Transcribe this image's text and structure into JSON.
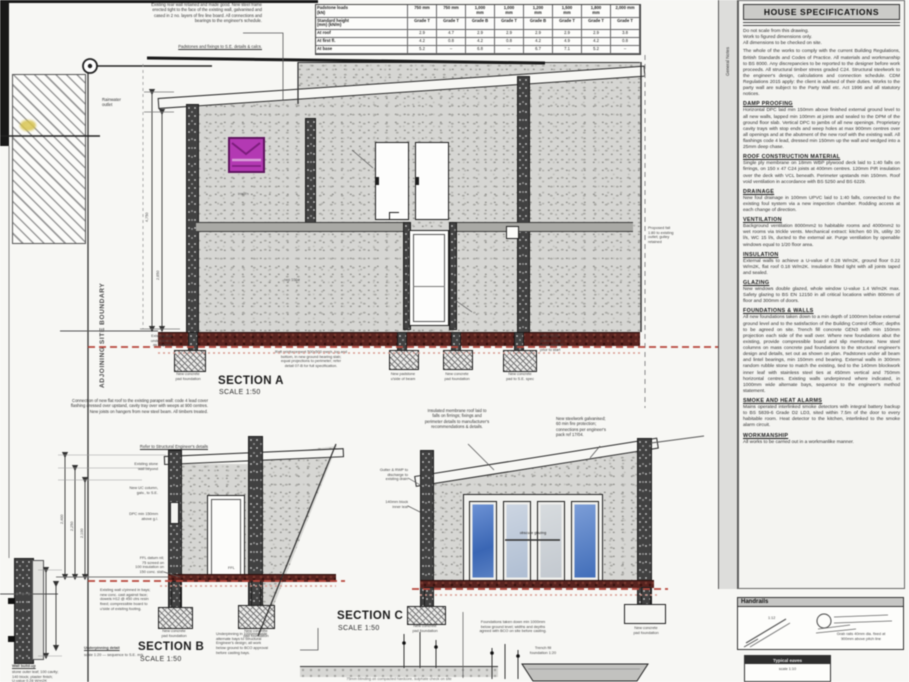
{
  "colors": {
    "accent_magenta": "#b339b3",
    "slab_maroon": "#58231f",
    "dash_red": "#b8473c",
    "glazing_blue": "#3f6cb8"
  },
  "boundary": {
    "left_vertical": "ADJOINING SITE BOUNDARY",
    "right_vertical": "SITE BOUNDARY",
    "sidebar_vertical": "General Notes"
  },
  "top_left": {
    "corner_note": "Rainwater\noutlet"
  },
  "top_note": {
    "body": "Existing rear wall retained and made good. New steel frame erected tight to the face of the existing wall, galvanised and cased in 2 no. layers of fire line board. All connections and bearings to the engineer's schedule.",
    "ref": "Padstones and fixings to S.E. details & calcs."
  },
  "table": {
    "header1": [
      "Padstone loads\n(kN)",
      "750 mm",
      "750 mm",
      "1,000\nmm",
      "1,000\nmm",
      "1,200\nmm",
      "1,500\nmm",
      "1,800\nmm",
      "2,000 mm"
    ],
    "header2": [
      "Standard height\n(mm) (kN/m)",
      "Grade T",
      "Grade T",
      "Grade B",
      "Grade T",
      "Grade B",
      "Grade T",
      "Grade T",
      "Grade T"
    ],
    "rows": [
      [
        "At roof",
        "2.9",
        "4.7",
        "2.9",
        "2.9",
        "2.9",
        "2.9",
        "2.9",
        "3.8"
      ],
      [
        "At first fl.",
        "4.2",
        "0.8",
        "4.2",
        "0.8",
        "4.2",
        "4.9",
        "4.2",
        "0.8"
      ],
      [
        "At base",
        "5.2",
        "–",
        "6.8",
        "–",
        "6.7",
        "7.1",
        "5.2",
        "–"
      ]
    ]
  },
  "right_panel": {
    "title": "HOUSE SPECIFICATIONS",
    "intro": "Do not scale from this drawing.\nWork to figured dimensions only.\nAll dimensions to be checked on site.",
    "general": "The whole of the works to comply with the current Building Regulations, British Standards and Codes of Practice. All materials and workmanship to BS 8000. Any discrepancies to be reported to the designer before work proceeds. All structural timber stress graded C24. Structural steelwork to the engineer's design, calculations and connection schedule. CDM Regulations 2015 apply: the client is advised of their duties. Works to the party wall are subject to the Party Wall etc. Act 1996 and all statutory notices.",
    "sections": [
      {
        "heading": "DAMP PROOFING",
        "body": "Horizontal DPC laid min 150mm above finished external ground level to all new walls, lapped min 100mm at joints and sealed to the DPM of the ground floor slab. Vertical DPC to jambs of all new openings. Proprietary cavity trays with stop ends and weep holes at max 900mm centres over all openings and at the abutment of the new roof with the existing wall. All flashings code 4 lead, dressed min 150mm up the wall and wedged into a 25mm deep chase."
      },
      {
        "heading": "ROOF CONSTRUCTION MATERIAL",
        "body": "Single ply membrane on 18mm WBP plywood deck laid to 1:40 falls on firrings, on 150 x 47 C24 joists at 400mm centres. 120mm PIR insulation over the deck with VCL beneath. Perimeter upstands min 150mm. Roof void ventilation in accordance with BS 5250 and BS 6229."
      },
      {
        "heading": "DRAINAGE",
        "body": "New foul drainage in 100mm UPVC laid to 1:40 falls, connected to the existing foul system via a new inspection chamber. Rodding access at each change of direction."
      },
      {
        "heading": "VENTILATION",
        "body": "Background ventilation 8000mm2 to habitable rooms and 4000mm2 to wet rooms via trickle vents. Mechanical extract: kitchen 60 l/s, utility 30 l/s, WC 15 l/s, ducted to the external air. Purge ventilation by openable windows equal to 1/20 floor area."
      },
      {
        "heading": "INSULATION",
        "body": "External walls to achieve a U-value of 0.28 W/m2K, ground floor 0.22 W/m2K, flat roof 0.18 W/m2K. Insulation fitted tight with all joints taped and sealed."
      },
      {
        "heading": "GLAZING",
        "body": "New windows double glazed, whole window U-value 1.4 W/m2K max. Safety glazing to BS EN 12150 in all critical locations within 800mm of floor and 300mm of doors."
      },
      {
        "heading": "FOUNDATIONS & WALLS",
        "body": "All new foundations taken down to a min depth of 1000mm below external ground level and to the satisfaction of the Building Control Officer; depths to be agreed on site. Trench fill concrete GEN3 with min 150mm projection each side of the wall over. Where new foundations abut the existing, provide compressible board and slip membrane. New steel columns on mass concrete pad foundations to the structural engineer's design and details, set out as shown on plan. Padstones under all beam and lintel bearings, min 150mm end bearing. External walls in 300mm random rubble stone to match the existing, tied to the 140mm blockwork inner leaf with stainless steel ties at 450mm vertical and 750mm horizontal centres. Existing walls underpinned where indicated, in 1000mm wide alternate bays, sequence to the engineer's method statement."
      },
      {
        "heading": "SMOKE AND HEAT ALARMS",
        "body": "Mains operated interlinked smoke detectors with integral battery backup to BS 5839-6 Grade D2 LD3, sited within 7.5m of the door to every habitable room. Heat detector to the kitchen, interlinked to the smoke alarm circuit."
      },
      {
        "heading": "WORKMANSHIP",
        "body": "All works to be carried out in a workmanlike manner."
      }
    ]
  },
  "section_a": {
    "label": "SECTION A",
    "scale": "SCALE 1:50",
    "left_note": "Existing wall\nunderpinned\nas required",
    "slab_note": "Raft reinforcement 500x500 mesh, top and\nbottom, in new ground bearing slab;\nequal projections to perimeter; refer\ndetail 07-B for full specification.",
    "right_note": "Proposed fall\n1:80 to existing\noutlet; gulley\nretained",
    "datum_note": "+FFL 00.00\n(datum); site\nlevels verified\nprior to start",
    "wall_tag": "insul'n",
    "rwp_tag": "rwp 100ø",
    "dim1": "4,750",
    "dim2": "2,650",
    "footing_captions": [
      "New concrete\npad foundation",
      "New padstone\nu'side of beam",
      "New concrete\npad foundation",
      "New concrete\npad to S.E. spec"
    ]
  },
  "section_b": {
    "label": "SECTION B",
    "scale": "SCALE 1:50",
    "top_note": "Connection of new flat roof to the existing parapet wall: code 4 lead cover flashing dressed over upstand, cavity tray over with weeps at 900 centres. New joists on hangers from new steel beam. All timbers treated.",
    "ref": "Refer to Structural Engineer's details",
    "left_notes": [
      "Existing stone\nwall beyond",
      "New UC column,\ngalv., to S.E.",
      "DPC min 150mm\nabove g.l."
    ],
    "ffl": "FFL",
    "base_note": "FFL datum nil;\n75 screed on\n100 insulation on\n150 conc. slab",
    "right_note": "Underpinning in 1000mm wide\nalternate bays to Structural\nEngineer's design; all work\nbelow ground to BCO approval\nbefore casting bays.",
    "dims": [
      "2,400",
      "2,250",
      "2,100"
    ],
    "footing_captions": [
      "New concrete\npad foundation",
      "New concrete\npad foundation"
    ]
  },
  "section_c": {
    "label": "SECTION C",
    "scale": "SCALE 1:50",
    "top_note_1": "Insulated membrane roof laid to\nfalls on firrings; fixings and\nperimeter details to manufacturer's\nrecommendations & details.",
    "top_note_2": "New steelwork galvanised;\n60 min fire protection;\nconnections per engineer's\npack ref 17/04.",
    "left_notes": [
      "Gutter & RWP to\ndischarge to\nexisting drain",
      "140mm block\ninner leaf"
    ],
    "glazing_label": "obscure glazing",
    "bottom_note": "Foundations taken down min 1000mm\nbelow ground level; widths and depths\nagreed with BCO on site before casting.",
    "footing_captions": [
      "New concrete\npad foundation",
      "New concrete\npad foundation"
    ]
  },
  "details": {
    "ground_note": "75mm blinding on compacted hardcore, sulphate check on site",
    "trench_caption": "Trench fill\nfoundation 1:20",
    "bottom_left_note": "Existing wall u'pinned in bays;\nnew conc. cast against face;\ndowels H12 @ 450 ctrs resin\nfixed; compressible board to\nu'side of existing footing.",
    "bottom_left_caption_title": "Underpinning detail",
    "bottom_left_caption_rest": "scale 1:20 — sequence to S.E. m/s",
    "corner_title": "Wall build-up",
    "corner_rest": "stone outer leaf; 100 cavity;\n140 block; plaster finish;\nU-value 0.28 W/m2K"
  },
  "handrails": {
    "title": "Handrails",
    "caption": "Grab rails 40mm dia. fixed at\n900mm above pitch line",
    "slope": "1:12"
  },
  "mini_box": {
    "title": "Typical eaves",
    "line": "scale 1:10"
  }
}
